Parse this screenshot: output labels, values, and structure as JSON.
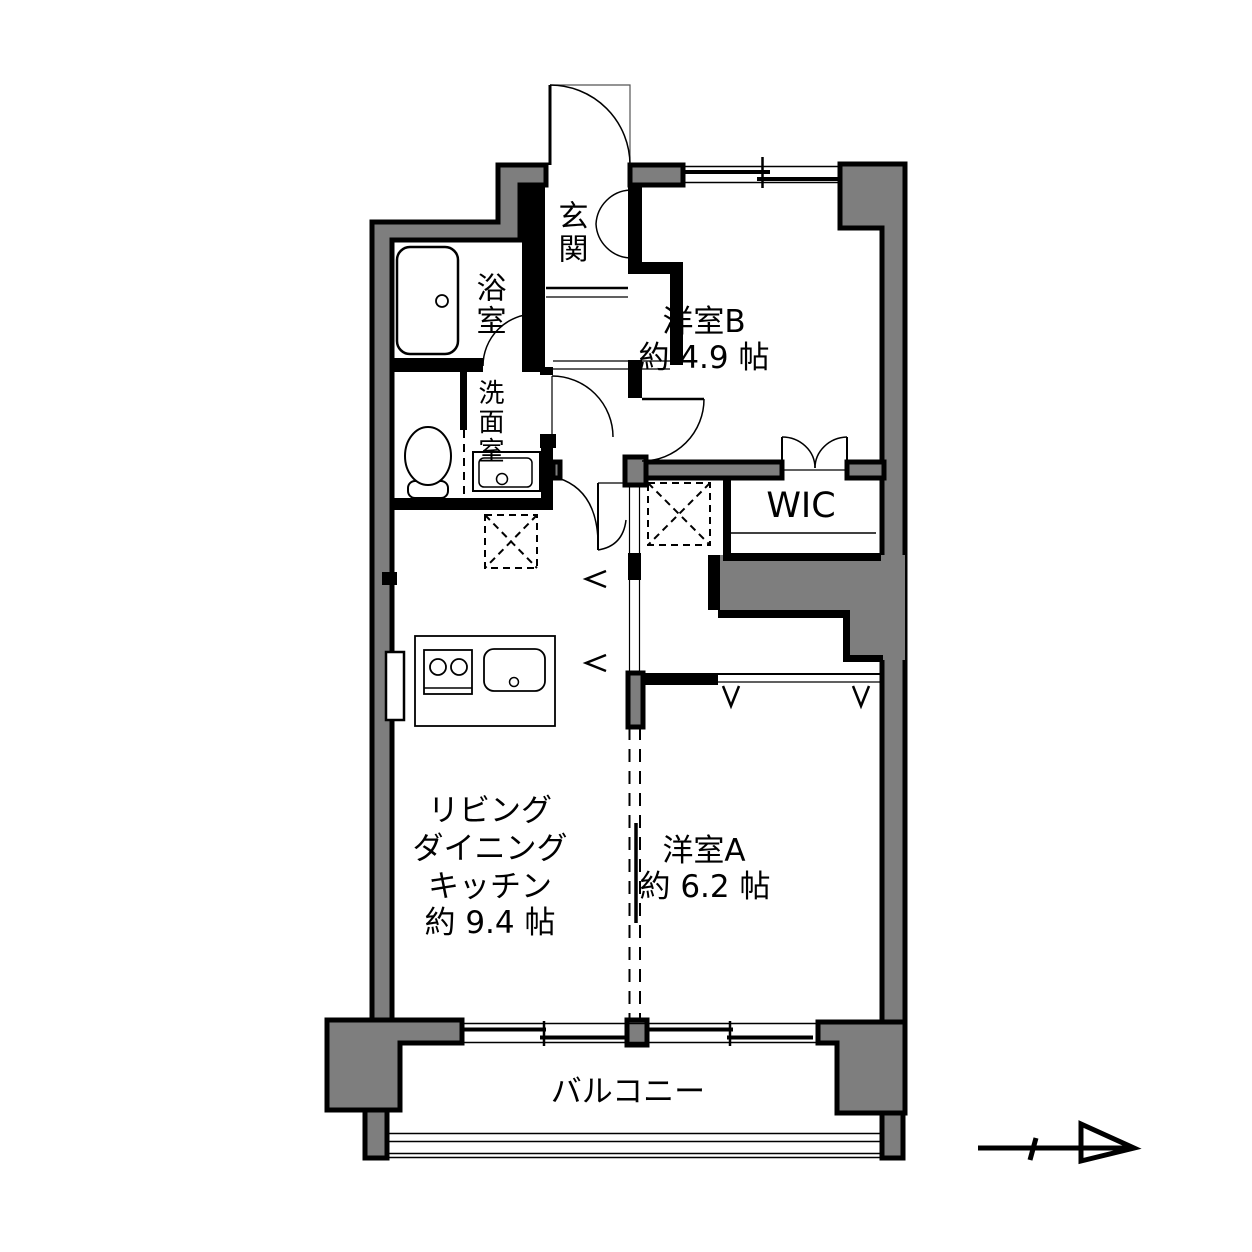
{
  "colors": {
    "wall_fill": "#7e7e7e",
    "line": "#000000",
    "floor": "#ffffff"
  },
  "floor_plan": {
    "rooms": {
      "genkan": {
        "label": "玄関"
      },
      "bathroom": {
        "label": "浴室"
      },
      "washroom": {
        "label": "洗面室"
      },
      "western_room_b": {
        "label": "洋室B",
        "area": "約 4.9 帖"
      },
      "wic": {
        "label": "WIC"
      },
      "ldk": {
        "label_line1": "リビング",
        "label_line2": "ダイニング",
        "label_line3": "キッチン",
        "area": "約 9.4 帖"
      },
      "western_room_a": {
        "label": "洋室A",
        "area": "約 6.2 帖"
      },
      "balcony": {
        "label": "バルコニー"
      }
    },
    "icons": {
      "north_arrow": "north-arrow"
    }
  }
}
